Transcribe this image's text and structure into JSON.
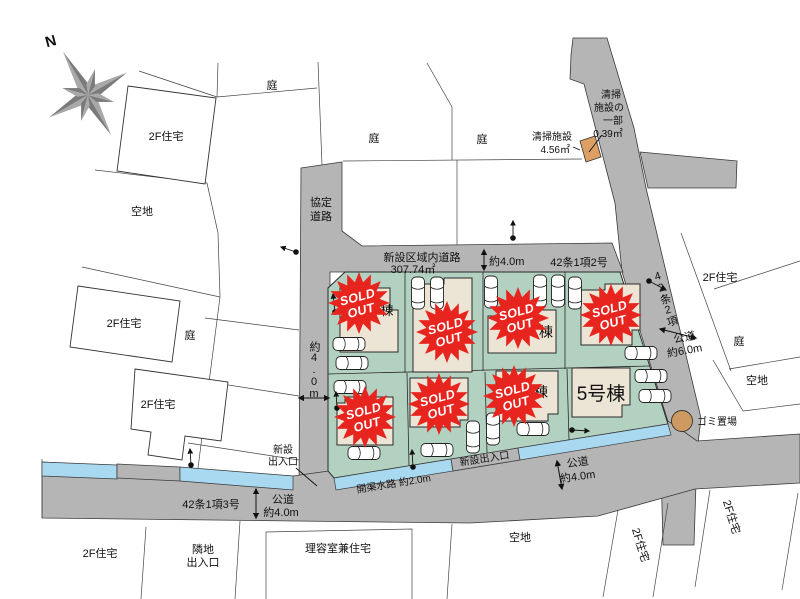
{
  "colors": {
    "road_gray": "#b5b5b6",
    "site_green": "#b3d1c1",
    "water_blue": "#a9d9f1",
    "house_beige": "#ece4d4",
    "badge_red": "#e8241e",
    "facility_orange": "#dd9f63",
    "garbage_tan": "#cf9a62"
  },
  "compass": {
    "north": "N"
  },
  "roads": {
    "agreement_line1": "協定",
    "agreement_line2": "道路",
    "new_area_road_line1": "新設区域内道路",
    "new_area_road_line2": "307.74㎡",
    "top_width": "約4.0m",
    "article_42_1_2": "42条1項2号",
    "article_42_2": "42条2項",
    "right_public_line1": "公道",
    "right_public_line2": "約6.0m",
    "left_width": "約4.0m",
    "article_42_1_3": "42条1項3号",
    "bottom_public_line1": "公道",
    "bottom_public_line2": "約4.0m",
    "center_public_line1": "公道",
    "center_public_line2": "約4.0m"
  },
  "water": {
    "channel_label": "開渠水路 約2.0m"
  },
  "entrances": {
    "new_left_line1": "新設",
    "new_left_line2": "出入口",
    "new_center": "新設出入口",
    "neighbor_line1": "隣地",
    "neighbor_line2": "出入口"
  },
  "facilities": {
    "cleaning_line1": "清掃施設",
    "cleaning_line2": "4.56㎡",
    "cleaning_part_line1": "清掃",
    "cleaning_part_line2": "施設の",
    "cleaning_part_line3": "一部",
    "cleaning_part_line4": "0.39㎡",
    "garbage": "ゴミ置場"
  },
  "lots": {
    "badge_line1": "SOLD",
    "badge_line2": "OUT",
    "lot1_fragment": "棟",
    "lot3_fragment": "棟",
    "lot7_fragment": "棟",
    "lot8_label": "5号棟"
  },
  "neighbors": {
    "house_2f": "2F住宅",
    "yard": "庭",
    "vacant": "空地",
    "barber_house": "理容室兼住宅"
  }
}
